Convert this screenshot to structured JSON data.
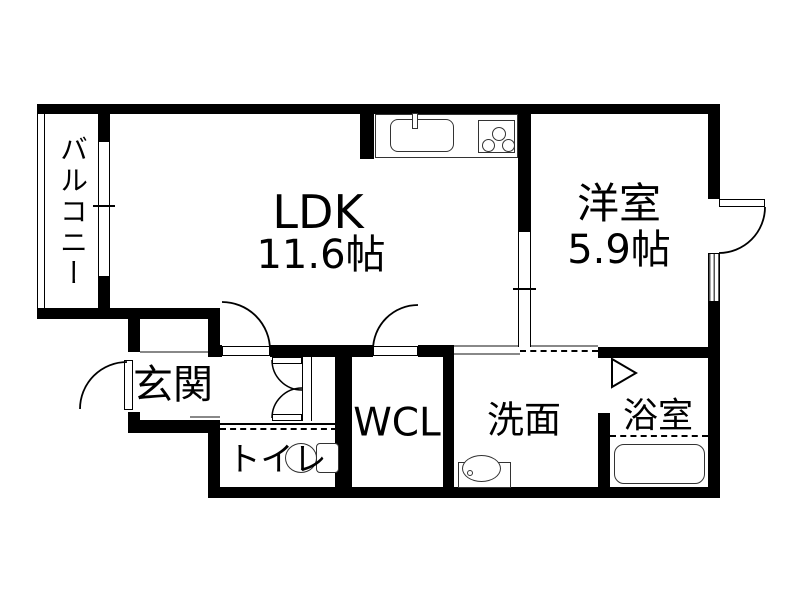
{
  "floorplan": {
    "background": "#ffffff",
    "wall_color": "#000000",
    "line_color": "#888888",
    "rooms": {
      "balcony": {
        "label": "バルコニー"
      },
      "ldk": {
        "label": "LDK",
        "size": "11.6帖"
      },
      "western_room": {
        "label": "洋室",
        "size": "5.9帖"
      },
      "entrance": {
        "label": "玄関"
      },
      "toilet": {
        "label": "トイレ"
      },
      "walk_in_closet": {
        "label": "WCL"
      },
      "washroom": {
        "label": "洗面"
      },
      "bathroom": {
        "label": "浴室"
      }
    },
    "fixtures": [
      "kitchen-sink-icon",
      "gas-stove-icon",
      "toilet-icon",
      "washbasin-icon",
      "bathtub-icon"
    ]
  }
}
